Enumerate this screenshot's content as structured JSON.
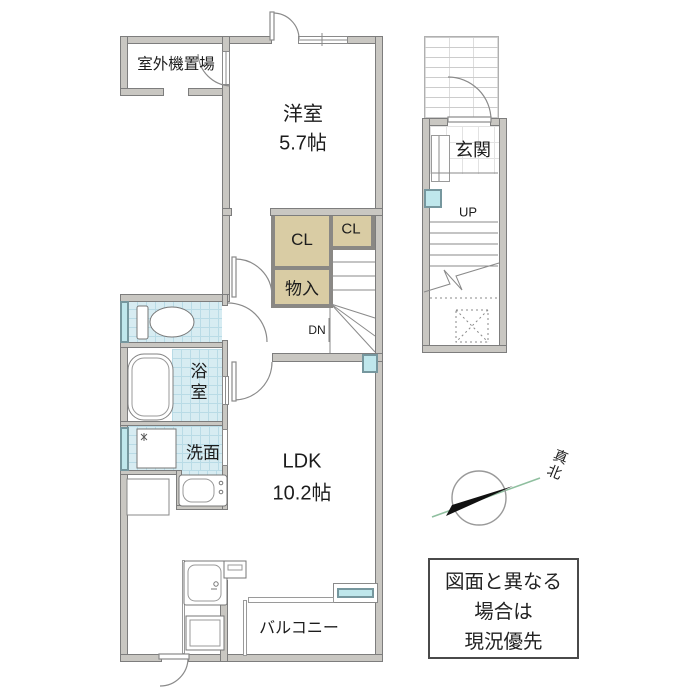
{
  "rooms": {
    "outdoor_unit": {
      "label": "室外機置場"
    },
    "western": {
      "label": "洋室",
      "size": "5.7帖"
    },
    "closet_main": {
      "label": "CL"
    },
    "closet_small": {
      "label": "CL"
    },
    "storage": {
      "label": "物入"
    },
    "entrance": {
      "label": "玄関"
    },
    "bath": {
      "label": "浴室"
    },
    "wash": {
      "label": "洗面"
    },
    "ldk": {
      "label": "LDK",
      "size": "10.2帖"
    },
    "balcony": {
      "label": "バルコニー"
    }
  },
  "stairs": {
    "down_label": "DN",
    "up_label": "UP"
  },
  "compass": {
    "north_label": "N",
    "true_north_label": "真北"
  },
  "disclaimer": {
    "lines": [
      "図面と異なる",
      "場合は",
      "現況優先"
    ]
  },
  "colors": {
    "wall_fill": "#c9c7c2",
    "wall_edge": "#7d7d7d",
    "tile_fill": "#d7ecf2",
    "tile_grid": "#b9dbe6",
    "closet_fill": "#d9cca4",
    "window_glass": "#bfe7ec",
    "compass_needle": "#111111",
    "north_line": "#8fbf9f"
  }
}
